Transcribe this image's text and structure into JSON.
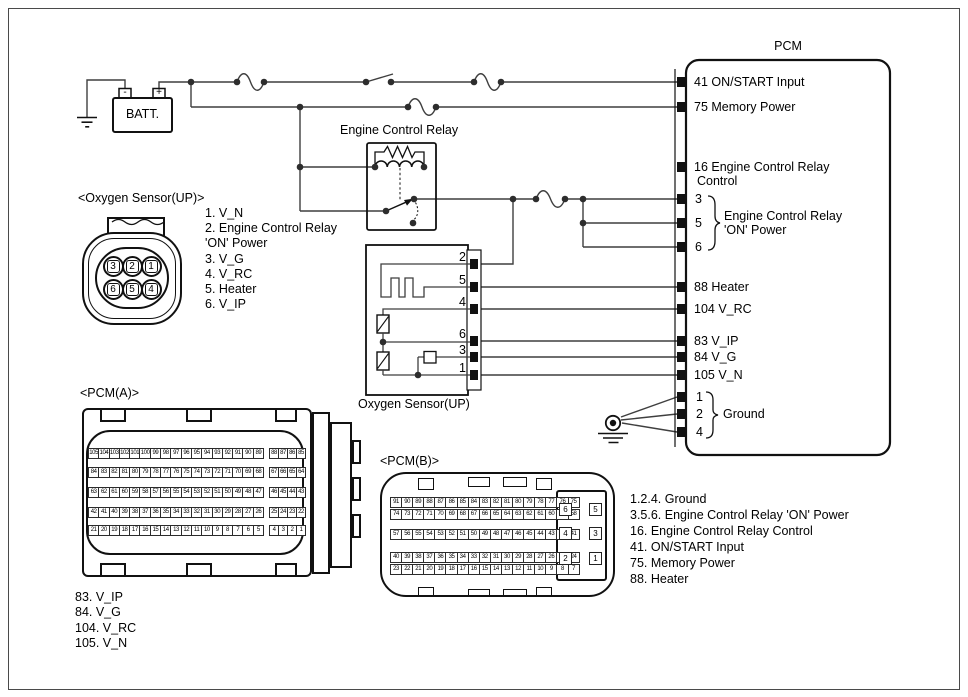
{
  "battery": {
    "label": "BATT.",
    "neg": "-",
    "pos": "+"
  },
  "relay": {
    "title": "Engine Control Relay"
  },
  "pcm": {
    "title": "PCM",
    "pins": {
      "p41": "41 ON/START Input",
      "p75": "75 Memory Power",
      "p16a": "16 Engine Control Relay",
      "p16b": "Control",
      "p3": "3",
      "p5": "5",
      "p6": "6",
      "on_power_a": "Engine Control Relay",
      "on_power_b": "'ON' Power",
      "p88": "88 Heater",
      "p104": "104 V_RC",
      "p83": "83 V_IP",
      "p84": "84 V_G",
      "p105": "105 V_N",
      "p1": "1",
      "p2": "2",
      "p4": "4",
      "ground": "Ground"
    }
  },
  "o2_box": {
    "title": "Oxygen Sensor(UP)",
    "pins": [
      "2",
      "5",
      "4",
      "6",
      "3",
      "1"
    ]
  },
  "o2_connector": {
    "title": "<Oxygen Sensor(UP)>",
    "pins_top": [
      "3",
      "2",
      "1"
    ],
    "pins_bottom": [
      "6",
      "5",
      "4"
    ],
    "legend": [
      "1. V_N",
      "2. Engine Control Relay",
      "'ON' Power",
      "3. V_G",
      "4. V_RC",
      "5. Heater",
      "6. V_IP"
    ]
  },
  "pcm_a": {
    "title": "<PCM(A)>",
    "rows": [
      {
        "main": [
          "105",
          "104",
          "103",
          "102",
          "101",
          "100",
          "99",
          "98",
          "97",
          "96",
          "95",
          "94",
          "93",
          "92",
          "91",
          "90",
          "89"
        ],
        "sub": [
          "88",
          "87",
          "86",
          "85"
        ]
      },
      {
        "main": [
          "84",
          "83",
          "82",
          "81",
          "80",
          "79",
          "78",
          "77",
          "76",
          "75",
          "74",
          "73",
          "72",
          "71",
          "70",
          "69",
          "68"
        ],
        "sub": [
          "67",
          "66",
          "65",
          "64"
        ]
      },
      {
        "main": [
          "63",
          "62",
          "61",
          "60",
          "59",
          "58",
          "57",
          "56",
          "55",
          "54",
          "53",
          "52",
          "51",
          "50",
          "49",
          "48",
          "47"
        ],
        "sub": [
          "46",
          "45",
          "44",
          "43"
        ]
      },
      {
        "main": [
          "42",
          "41",
          "40",
          "39",
          "38",
          "37",
          "36",
          "35",
          "34",
          "33",
          "32",
          "31",
          "30",
          "29",
          "28",
          "27",
          "26"
        ],
        "sub": [
          "25",
          "24",
          "23",
          "22"
        ]
      },
      {
        "main": [
          "21",
          "20",
          "19",
          "18",
          "17",
          "16",
          "15",
          "14",
          "13",
          "12",
          "11",
          "10",
          "9",
          "8",
          "7",
          "6",
          "5"
        ],
        "sub": [
          "4",
          "3",
          "2",
          "1"
        ]
      }
    ],
    "legend": [
      "83. V_IP",
      "84. V_G",
      "104. V_RC",
      "105. V_N"
    ]
  },
  "pcm_b": {
    "title": "<PCM(B)>",
    "rows": [
      [
        "91",
        "90",
        "89",
        "88",
        "87",
        "86",
        "85",
        "84",
        "83",
        "82",
        "81",
        "80",
        "79",
        "78",
        "77",
        "76",
        "75"
      ],
      [
        "74",
        "73",
        "72",
        "71",
        "70",
        "69",
        "68",
        "67",
        "66",
        "65",
        "64",
        "63",
        "62",
        "61",
        "60",
        "59",
        "58"
      ],
      [
        "57",
        "56",
        "55",
        "54",
        "53",
        "52",
        "51",
        "50",
        "49",
        "48",
        "47",
        "46",
        "45",
        "44",
        "43",
        "42",
        "41"
      ],
      [
        "40",
        "39",
        "38",
        "37",
        "36",
        "35",
        "34",
        "33",
        "32",
        "31",
        "30",
        "29",
        "28",
        "27",
        "26",
        "25",
        "24"
      ],
      [
        "23",
        "22",
        "21",
        "20",
        "19",
        "18",
        "17",
        "16",
        "15",
        "14",
        "13",
        "12",
        "11",
        "10",
        "9",
        "8",
        "7"
      ]
    ],
    "big_pins": [
      "6",
      "5",
      "4",
      "3",
      "2",
      "1"
    ],
    "legend": [
      "1.2.4. Ground",
      "3.5.6. Engine Control Relay 'ON' Power",
      "16. Engine Control Relay Control",
      "41. ON/START Input",
      "75. Memory Power",
      "88. Heater"
    ]
  }
}
